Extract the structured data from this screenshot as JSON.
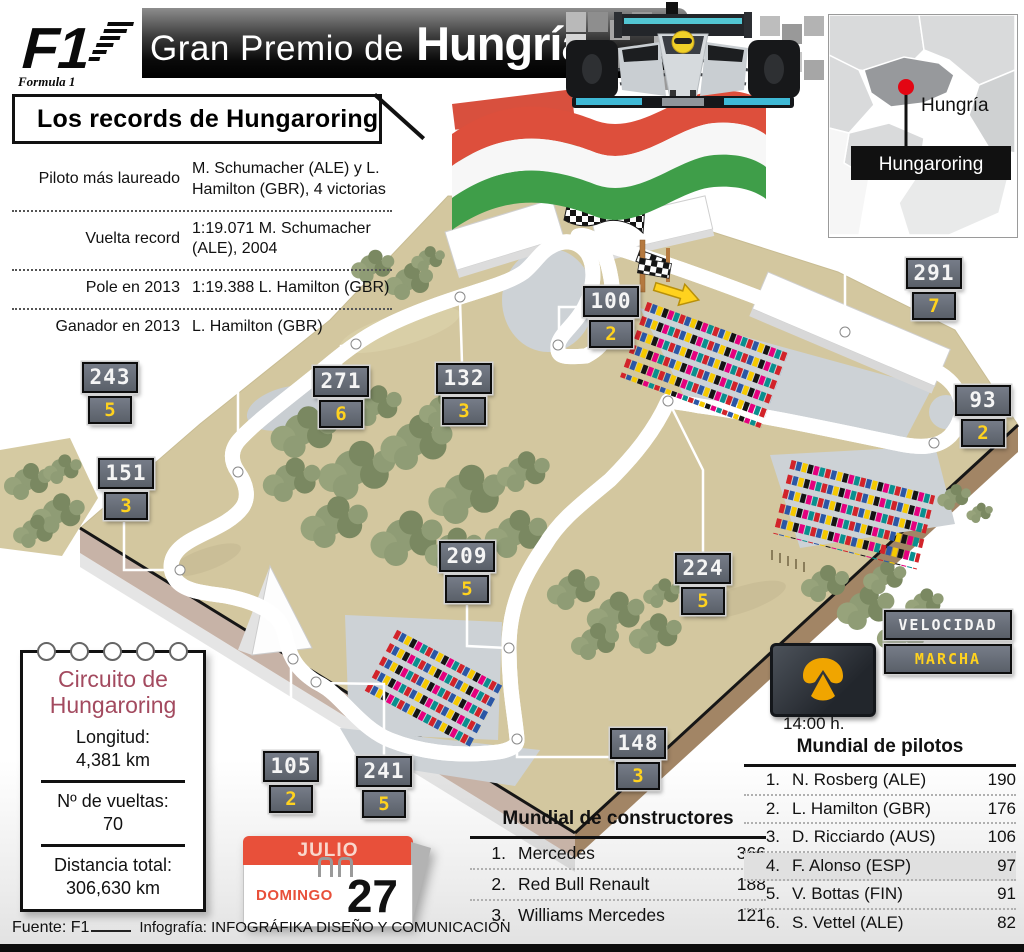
{
  "header": {
    "f1_logo": "F1",
    "f1_sub": "Formula 1",
    "title_regular": "Gran Premio de",
    "title_bold": "Hungría"
  },
  "map": {
    "country": "Hungría",
    "circuit": "Hungaroring"
  },
  "records": {
    "title": "Los records de Hungaroring",
    "rows": [
      {
        "label": "Piloto más laureado",
        "value": "M. Schumacher (ALE) y L. Hamilton (GBR), 4 victorias"
      },
      {
        "label": "Vuelta record",
        "value": "1:19.071 M. Schumacher (ALE), 2004"
      },
      {
        "label": "Pole en 2013",
        "value": "1:19.388 L. Hamilton (GBR)"
      },
      {
        "label": "Ganador en 2013",
        "value": "L. Hamilton (GBR)"
      }
    ]
  },
  "circuit": {
    "markers": [
      {
        "speed": "243",
        "gear": "5"
      },
      {
        "speed": "271",
        "gear": "6"
      },
      {
        "speed": "132",
        "gear": "3"
      },
      {
        "speed": "100",
        "gear": "2"
      },
      {
        "speed": "291",
        "gear": "7"
      },
      {
        "speed": "93",
        "gear": "2"
      },
      {
        "speed": "151",
        "gear": "3"
      },
      {
        "speed": "209",
        "gear": "5"
      },
      {
        "speed": "224",
        "gear": "5"
      },
      {
        "speed": "148",
        "gear": "3"
      },
      {
        "speed": "105",
        "gear": "2"
      },
      {
        "speed": "241",
        "gear": "5"
      }
    ],
    "legend": {
      "speed_label": "VELOCIDAD",
      "gear_label": "MARCHA"
    }
  },
  "broadcast": {
    "time": "14:00 h."
  },
  "note": {
    "title1": "Circuito de",
    "title2": "Hungaroring",
    "items": [
      {
        "label": "Longitud:",
        "value": "4,381 km"
      },
      {
        "label": "Nº de vueltas:",
        "value": "70"
      },
      {
        "label": "Distancia total:",
        "value": "306,630 km"
      }
    ]
  },
  "calendar": {
    "month": "JULIO",
    "day_name": "DOMINGO",
    "day_number": "27"
  },
  "constructors": {
    "title": "Mundial de constructores",
    "rows": [
      {
        "pos": "1.",
        "name": "Mercedes",
        "points": "366"
      },
      {
        "pos": "2.",
        "name": "Red Bull Renault",
        "points": "188"
      },
      {
        "pos": "3.",
        "name": "Williams Mercedes",
        "points": "121"
      }
    ]
  },
  "drivers": {
    "title": "Mundial de pilotos",
    "rows": [
      {
        "pos": "1.",
        "name": "N. Rosberg (ALE)",
        "points": "190"
      },
      {
        "pos": "2.",
        "name": "L. Hamilton (GBR)",
        "points": "176"
      },
      {
        "pos": "3.",
        "name": "D. Ricciardo (AUS)",
        "points": "106"
      },
      {
        "pos": "4.",
        "name": "F. Alonso (ESP)",
        "points": "97"
      },
      {
        "pos": "5.",
        "name": "V. Bottas (FIN)",
        "points": "91"
      },
      {
        "pos": "6.",
        "name": "S. Vettel (ALE)",
        "points": "82"
      }
    ]
  },
  "footer": {
    "source": "Fuente: F1",
    "credit": "Infografía: INFOGRÁFIKA DISEÑO Y COMUNICACIÓN"
  },
  "colors": {
    "calendar_orange": "#e8503a",
    "digital_yellow": "#ffd21e",
    "flag_red": "#dd4f3c",
    "flag_green": "#3f9e49",
    "note_title_red": "#a34a5f",
    "map_marker_red": "#e30613"
  }
}
